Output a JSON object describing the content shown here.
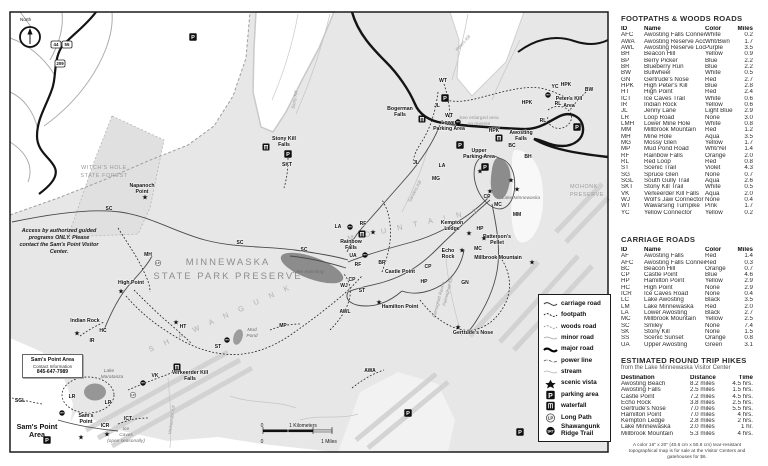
{
  "map": {
    "north_label": "North",
    "shields": [
      {
        "nums": [
          "44",
          "55"
        ],
        "x": 51,
        "y": 41
      },
      {
        "nums": [
          "209"
        ],
        "x": 55,
        "y": 60
      }
    ],
    "access_note": "Access by authorized guided programs ONLY. Please contact the Sam's Point Visitor Center.",
    "sams_box": {
      "title": "Sam's Point Area",
      "sub": "Contact Information",
      "phone": "845-647-7989"
    },
    "scale": [
      {
        "t": "0",
        "x": 262,
        "y": 427
      },
      {
        "t": "1 Kilometers",
        "x": 303,
        "y": 427
      },
      {
        "t": "0",
        "x": 262,
        "y": 443
      },
      {
        "t": "1 Miles",
        "x": 329,
        "y": 443
      }
    ],
    "labels": [
      {
        "t": "North",
        "x": 20,
        "y": 21,
        "c": "small",
        "a": "start"
      },
      {
        "t": "MINNEWASKA",
        "x": 228,
        "y": 265,
        "c": "parktitle"
      },
      {
        "t": "STATE PARK PRESERVE",
        "x": 228,
        "y": 279,
        "c": "parktitle"
      },
      {
        "t": "S H A W A N G U N K",
        "x": 150,
        "y": 352,
        "c": "ridge",
        "rot": -24
      },
      {
        "t": "M O U N T A I N S",
        "x": 348,
        "y": 241,
        "c": "ridge",
        "rot": -12
      },
      {
        "t": "WITCH'S HOLE",
        "x": 104,
        "y": 169,
        "c": "graycaps"
      },
      {
        "t": "STATE FOREST",
        "x": 104,
        "y": 177,
        "c": "graycaps"
      },
      {
        "t": "MOHONK",
        "x": 584,
        "y": 188,
        "c": "graycaps"
      },
      {
        "t": "PRESERVE",
        "x": 587,
        "y": 196,
        "c": "graycaps"
      },
      {
        "t": "Napanoch",
        "x": 142,
        "y": 187,
        "c": "place"
      },
      {
        "t": "Point",
        "x": 142,
        "y": 193,
        "c": "place"
      },
      {
        "t": "High Point",
        "x": 131,
        "y": 284,
        "c": "place"
      },
      {
        "t": "Indian Rock",
        "x": 85,
        "y": 322,
        "c": "place"
      },
      {
        "t": "Bogerman",
        "x": 400,
        "y": 110,
        "c": "place"
      },
      {
        "t": "Falls",
        "x": 400,
        "y": 116,
        "c": "place"
      },
      {
        "t": "Lower",
        "x": 449,
        "y": 124,
        "c": "place"
      },
      {
        "t": "Parking Area",
        "x": 449,
        "y": 130,
        "c": "place"
      },
      {
        "t": "Upper",
        "x": 479,
        "y": 152,
        "c": "place"
      },
      {
        "t": "Parking Area",
        "x": 479,
        "y": 158,
        "c": "place"
      },
      {
        "t": "Awosting",
        "x": 521,
        "y": 134,
        "c": "place"
      },
      {
        "t": "Falls",
        "x": 521,
        "y": 140,
        "c": "place"
      },
      {
        "t": "Peter's Kill",
        "x": 569,
        "y": 100,
        "c": "place"
      },
      {
        "t": "Area",
        "x": 569,
        "y": 107,
        "c": "place"
      },
      {
        "t": "Stony Kill",
        "x": 284,
        "y": 140,
        "c": "place"
      },
      {
        "t": "Falls",
        "x": 284,
        "y": 146,
        "c": "place"
      },
      {
        "t": "See enlarged area",
        "x": 479,
        "y": 119,
        "c": "graynote"
      },
      {
        "t": "on reverse",
        "x": 479,
        "y": 125,
        "c": "graynote"
      },
      {
        "t": "Kempton",
        "x": 452,
        "y": 224,
        "c": "place"
      },
      {
        "t": "Ledge",
        "x": 452,
        "y": 230,
        "c": "place"
      },
      {
        "t": "Patterson's",
        "x": 497,
        "y": 238,
        "c": "place"
      },
      {
        "t": "Pellet",
        "x": 497,
        "y": 244,
        "c": "place"
      },
      {
        "t": "Echo",
        "x": 448,
        "y": 252,
        "c": "place"
      },
      {
        "t": "Rock",
        "x": 448,
        "y": 258,
        "c": "place"
      },
      {
        "t": "Castle Point",
        "x": 400,
        "y": 273,
        "c": "place"
      },
      {
        "t": "Hamilton Point",
        "x": 400,
        "y": 308,
        "c": "place"
      },
      {
        "t": "Millbrook Mountain",
        "x": 498,
        "y": 259,
        "c": "place"
      },
      {
        "t": "Gertrude's Nose",
        "x": 473,
        "y": 334,
        "c": "place"
      },
      {
        "t": "Rainbow",
        "x": 351,
        "y": 243,
        "c": "place"
      },
      {
        "t": "Falls",
        "x": 351,
        "y": 249,
        "c": "place"
      },
      {
        "t": "Verkeerder Kill",
        "x": 190,
        "y": 374,
        "c": "place"
      },
      {
        "t": "Falls",
        "x": 190,
        "y": 380,
        "c": "place"
      },
      {
        "t": "Sam's",
        "x": 86,
        "y": 417,
        "c": "place"
      },
      {
        "t": "Point",
        "x": 86,
        "y": 423,
        "c": "place"
      },
      {
        "t": "Sam's Point",
        "x": 37,
        "y": 429,
        "c": "bigplace"
      },
      {
        "t": "Area",
        "x": 37,
        "y": 437,
        "c": "bigplace"
      },
      {
        "t": "Lake Minnewaska",
        "x": 521,
        "y": 199,
        "c": "lake"
      },
      {
        "t": "Lake Awosting",
        "x": 308,
        "y": 273,
        "c": "lake"
      },
      {
        "t": "Mud",
        "x": 252,
        "y": 331,
        "c": "lake"
      },
      {
        "t": "Pond",
        "x": 252,
        "y": 337,
        "c": "lake"
      },
      {
        "t": "Lake",
        "x": 109,
        "y": 372,
        "c": "lake"
      },
      {
        "t": "Maratanza",
        "x": 112,
        "y": 378,
        "c": "lake"
      },
      {
        "t": "Ice",
        "x": 126,
        "y": 430,
        "c": "lake",
        "a": "start"
      },
      {
        "t": "Caves",
        "x": 126,
        "y": 436,
        "c": "lake",
        "a": "start"
      },
      {
        "t": "(open seasonally)",
        "x": 126,
        "y": 442,
        "c": "lake",
        "a": "start"
      },
      {
        "t": "Sanders Kill",
        "x": 416,
        "y": 192,
        "c": "stream",
        "rot": -62
      },
      {
        "t": "Peters Kill",
        "x": 464,
        "y": 44,
        "c": "stream",
        "rot": -48
      },
      {
        "t": "Stony Kill",
        "x": 296,
        "y": 100,
        "c": "stream",
        "rot": -80
      },
      {
        "t": "Palmaghatt Kill",
        "x": 449,
        "y": 292,
        "c": "stream",
        "rot": -75
      },
      {
        "t": "Palmaghatt Ravine",
        "x": 440,
        "y": 300,
        "c": "stream",
        "rot": -75
      },
      {
        "t": "Verkeerder Kill",
        "x": 173,
        "y": 420,
        "c": "stream",
        "rot": -82
      }
    ],
    "trail_ids": [
      {
        "t": "SC",
        "x": 109,
        "y": 210
      },
      {
        "t": "SC",
        "x": 240,
        "y": 244
      },
      {
        "t": "SC",
        "x": 304,
        "y": 251
      },
      {
        "t": "HPK",
        "x": 527,
        "y": 104
      },
      {
        "t": "HPK",
        "x": 494,
        "y": 132
      },
      {
        "t": "HPK",
        "x": 566,
        "y": 86
      },
      {
        "t": "WT",
        "x": 443,
        "y": 82
      },
      {
        "t": "WT",
        "x": 449,
        "y": 117
      },
      {
        "t": "JL",
        "x": 437,
        "y": 107
      },
      {
        "t": "JL",
        "x": 416,
        "y": 164
      },
      {
        "t": "MG",
        "x": 436,
        "y": 180
      },
      {
        "t": "LA",
        "x": 442,
        "y": 167
      },
      {
        "t": "LA",
        "x": 338,
        "y": 228
      },
      {
        "t": "BC",
        "x": 512,
        "y": 147
      },
      {
        "t": "BH",
        "x": 528,
        "y": 158
      },
      {
        "t": "CP",
        "x": 487,
        "y": 198
      },
      {
        "t": "CP",
        "x": 428,
        "y": 268
      },
      {
        "t": "CP",
        "x": 352,
        "y": 281
      },
      {
        "t": "MC",
        "x": 498,
        "y": 206
      },
      {
        "t": "MC",
        "x": 478,
        "y": 250
      },
      {
        "t": "MM",
        "x": 517,
        "y": 216
      },
      {
        "t": "GN",
        "x": 465,
        "y": 284
      },
      {
        "t": "HP",
        "x": 480,
        "y": 230
      },
      {
        "t": "HP",
        "x": 424,
        "y": 283
      },
      {
        "t": "UA",
        "x": 353,
        "y": 257
      },
      {
        "t": "RF",
        "x": 363,
        "y": 225
      },
      {
        "t": "RF",
        "x": 358,
        "y": 266
      },
      {
        "t": "BR",
        "x": 382,
        "y": 264
      },
      {
        "t": "WJ",
        "x": 344,
        "y": 287
      },
      {
        "t": "ST",
        "x": 362,
        "y": 292
      },
      {
        "t": "ST",
        "x": 218,
        "y": 348
      },
      {
        "t": "AWL",
        "x": 345,
        "y": 313
      },
      {
        "t": "HT",
        "x": 183,
        "y": 328
      },
      {
        "t": "MH",
        "x": 148,
        "y": 256
      },
      {
        "t": "HC",
        "x": 103,
        "y": 332
      },
      {
        "t": "IR",
        "x": 92,
        "y": 342
      },
      {
        "t": "LR",
        "x": 72,
        "y": 398
      },
      {
        "t": "LR",
        "x": 108,
        "y": 404
      },
      {
        "t": "SGL",
        "x": 20,
        "y": 402
      },
      {
        "t": "ICR",
        "x": 105,
        "y": 427
      },
      {
        "t": "ICT",
        "x": 128,
        "y": 420
      },
      {
        "t": "VK",
        "x": 155,
        "y": 377
      },
      {
        "t": "RL",
        "x": 558,
        "y": 105
      },
      {
        "t": "RL",
        "x": 543,
        "y": 122
      },
      {
        "t": "YC",
        "x": 555,
        "y": 88
      },
      {
        "t": "BW",
        "x": 589,
        "y": 91
      },
      {
        "t": "SKT",
        "x": 287,
        "y": 166
      },
      {
        "t": "AWA",
        "x": 370,
        "y": 372
      },
      {
        "t": "MP",
        "x": 283,
        "y": 327
      }
    ],
    "stars": [
      [
        469,
        233
      ],
      [
        484,
        238
      ],
      [
        462,
        250
      ],
      [
        532,
        262
      ],
      [
        379,
        302
      ],
      [
        458,
        327
      ],
      [
        121,
        291
      ],
      [
        77,
        333
      ],
      [
        145,
        197
      ],
      [
        107,
        434
      ],
      [
        81,
        437
      ],
      [
        480,
        171
      ],
      [
        511,
        180
      ],
      [
        517,
        189
      ],
      [
        490,
        191
      ],
      [
        176,
        322
      ],
      [
        373,
        232
      ]
    ],
    "parking": [
      [
        445,
        98
      ],
      [
        460,
        145
      ],
      [
        485,
        167
      ],
      [
        577,
        127
      ],
      [
        288,
        154
      ],
      [
        47,
        440
      ],
      [
        520,
        432
      ],
      [
        408,
        413
      ],
      [
        193,
        37
      ]
    ],
    "waterfalls": [
      [
        422,
        119
      ],
      [
        499,
        138
      ],
      [
        266,
        147
      ],
      [
        362,
        234
      ],
      [
        177,
        367
      ]
    ],
    "srt_markers": [
      [
        548,
        95
      ],
      [
        458,
        122
      ],
      [
        350,
        227
      ],
      [
        365,
        255
      ],
      [
        227,
        340
      ],
      [
        143,
        383
      ],
      [
        62,
        413
      ]
    ],
    "lp_markers": [
      [
        133,
        395
      ],
      [
        158,
        263
      ]
    ]
  },
  "legend": {
    "items": [
      {
        "icon": "carriage-road",
        "label": "carriage road"
      },
      {
        "icon": "footpath",
        "label": "footpath"
      },
      {
        "icon": "woods-road",
        "label": "woods road"
      },
      {
        "icon": "minor-road",
        "label": "minor road"
      },
      {
        "icon": "major-road",
        "label": "major road"
      },
      {
        "icon": "power-line",
        "label": "power line"
      },
      {
        "icon": "stream",
        "label": "stream"
      },
      {
        "icon": "scenic-vista",
        "label": "scenic vista"
      },
      {
        "icon": "parking-area",
        "label": "parking area"
      },
      {
        "icon": "waterfall",
        "label": "waterfall"
      },
      {
        "icon": "long-path",
        "label": "Long Path"
      },
      {
        "icon": "srt",
        "label": "Shawangunk Ridge Trail"
      }
    ]
  },
  "tables": {
    "footpaths": {
      "title": "FOOTPATHS & WOODS ROADS",
      "columns": [
        "ID",
        "Name",
        "Color",
        "Miles"
      ],
      "rows": [
        [
          "AFC",
          "Awosting Falls Connector",
          "White",
          "0.2"
        ],
        [
          "AWA",
          "Awosting Reserve Access Rd",
          "Wht/Bwn",
          "1.7"
        ],
        [
          "AWL",
          "Awosting Reserve Loop",
          "Purple",
          "3.5"
        ],
        [
          "BH",
          "Beacon Hill",
          "Yellow",
          "0.9"
        ],
        [
          "BP",
          "Berry Picker",
          "Blue",
          "2.2"
        ],
        [
          "BR",
          "Blueberry Run",
          "Blue",
          "2.2"
        ],
        [
          "BW",
          "Bullwheel",
          "White",
          "0.5"
        ],
        [
          "GN",
          "Gertrude's Nose",
          "Red",
          "2.7"
        ],
        [
          "HPK",
          "High Peter's Kill",
          "Blue",
          "2.8"
        ],
        [
          "HT",
          "High Point",
          "Red",
          "2.4"
        ],
        [
          "ICT",
          "Ice Caves Trail",
          "White",
          "0.6"
        ],
        [
          "IR",
          "Indian Rock",
          "Yellow",
          "0.6"
        ],
        [
          "JL",
          "Jenny Lane",
          "Light Blue",
          "2.9"
        ],
        [
          "LR",
          "Loop Road",
          "None",
          "3.0"
        ],
        [
          "LMH",
          "Lower Mine Hole",
          "White",
          "0.8"
        ],
        [
          "MM",
          "Millbrook Mountain",
          "Red",
          "1.2"
        ],
        [
          "MH",
          "Mine Hole",
          "Aqua",
          "3.5"
        ],
        [
          "MG",
          "Mossy Glen",
          "Yellow",
          "1.7"
        ],
        [
          "MP",
          "Mud Pond Road",
          "Wht/Yel",
          "1.4"
        ],
        [
          "RF",
          "Rainbow Falls",
          "Orange",
          "2.0"
        ],
        [
          "RL",
          "Red Loop",
          "Red",
          "0.8"
        ],
        [
          "ST",
          "Scenic Trail",
          "Violet",
          "4.3"
        ],
        [
          "SG",
          "Spruce Glen",
          "None",
          "0.7"
        ],
        [
          "SGL",
          "South Gully Trail",
          "Aqua",
          "2.6"
        ],
        [
          "SKT",
          "Stony Kill Trail",
          "White",
          "0.5"
        ],
        [
          "VK",
          "Verkeerder Kill Falls",
          "Aqua",
          "2.0"
        ],
        [
          "WJ",
          "Wolf's Jaw Connector",
          "None",
          "0.4"
        ],
        [
          "WT",
          "Wawarsing Turnpike",
          "Pink",
          "1.7"
        ],
        [
          "YC",
          "Yellow Connector",
          "Yellow",
          "0.2"
        ]
      ]
    },
    "carriage": {
      "title": "CARRIAGE ROADS",
      "columns": [
        "ID",
        "Name",
        "Color",
        "Miles"
      ],
      "rows": [
        [
          "AF",
          "Awosting Falls",
          "Red",
          "1.4"
        ],
        [
          "AFC",
          "Awosting Falls Connection",
          "Red",
          "0.3"
        ],
        [
          "BC",
          "Beacon Hill",
          "Orange",
          "0.7"
        ],
        [
          "CP",
          "Castle Point",
          "Blue",
          "4.6"
        ],
        [
          "HP",
          "Hamilton Point",
          "Yellow",
          "2.9"
        ],
        [
          "HC",
          "High Point",
          "None",
          "2.9"
        ],
        [
          "ICR",
          "Ice Caves Road",
          "None",
          "0.4"
        ],
        [
          "LC",
          "Lake Awosting",
          "Black",
          "3.5"
        ],
        [
          "LM",
          "Lake Minnewaska",
          "Red",
          "2.0"
        ],
        [
          "LA",
          "Lower Awosting",
          "Black",
          "2.7"
        ],
        [
          "MC",
          "Millbrook Mountain",
          "Yellow",
          "2.5"
        ],
        [
          "SC",
          "Smiley",
          "None",
          "7.4"
        ],
        [
          "SK",
          "Stony Kill",
          "None",
          "1.5"
        ],
        [
          "SS",
          "Scenic Sunset",
          "Orange",
          "0.8"
        ],
        [
          "UA",
          "Upper Awosting",
          "Green",
          "3.1"
        ]
      ]
    },
    "hikes": {
      "title": "ESTIMATED ROUND TRIP HIKES",
      "subtitle": "from the Lake Minnewaska Visitor Center",
      "columns": [
        "Destination",
        "Distance",
        "Time"
      ],
      "rows": [
        [
          "Awosting Beach",
          "8.2 miles",
          "4.5 hrs."
        ],
        [
          "Awosting Falls",
          "2.5 miles",
          "1.5 hrs."
        ],
        [
          "Castle Point",
          "7.2 miles",
          "4.5 hrs."
        ],
        [
          "Echo Rock",
          "3.8 miles",
          "2.5 hrs."
        ],
        [
          "Gertrude's Nose",
          "7.0 miles",
          "5.5 hrs."
        ],
        [
          "Hamilton Point",
          "7.0 miles",
          "4 hrs."
        ],
        [
          "Kempton Ledge",
          "2.8 miles",
          "2 hrs."
        ],
        [
          "Lake Minnewaska",
          "2.0 miles",
          "1 hr."
        ],
        [
          "Millbrook Mountain",
          "5.3 miles",
          "4 hrs."
        ]
      ]
    },
    "footnote": "A color 16\" x 20\" (40.6 cm x 50.8 cm) tear-resistant topographical map is for sale at the Visitor Centers and gatehouses for $6."
  }
}
